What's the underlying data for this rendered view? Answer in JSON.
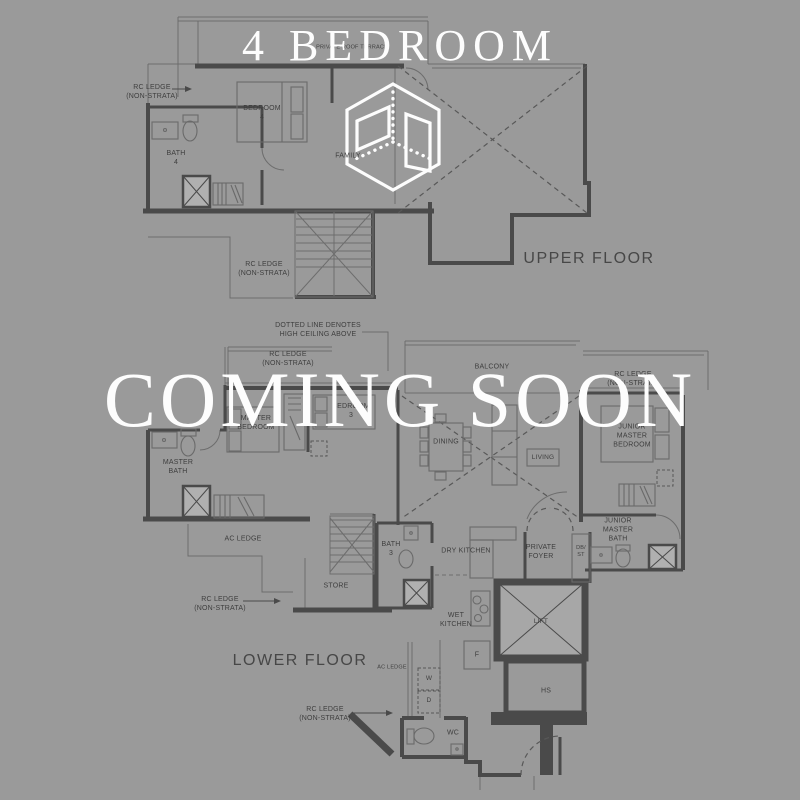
{
  "palette": {
    "background": "#9a9a9a",
    "wall": "#4a4a4a",
    "line": "#6d6d6d",
    "label": "#3e3e3e",
    "overlay": "#fdfdfd"
  },
  "overlay": {
    "title": "4 BEDROOM",
    "watermark": "COMING SOON",
    "logo_icon": "isometric-room-cube-logo"
  },
  "plan_labels": {
    "upper": {
      "floor_name": "UPPER FLOOR",
      "private_roof_terrace": "PRIVATE ROOF TERRACE",
      "rc_ledge_left": "RC LEDGE\n(NON-STRATA)",
      "bedroom_4": "BEDROOM\n4",
      "bath_4": "BATH\n4",
      "family": "FAMILY",
      "rc_ledge_mid": "RC LEDGE\n(NON-STRATA)"
    },
    "lower": {
      "floor_name": "LOWER FLOOR",
      "ceiling_note": "DOTTED LINE DENOTES\nHIGH CEILING ABOVE",
      "rc_ledge_top": "RC LEDGE\n(NON-STRATA)",
      "balcony": "BALCONY",
      "rc_ledge_right": "RC LEDGE\n(NON-STRATA)",
      "master_bedroom": "MASTER\nBEDROOM",
      "bedroom_3": "BEDROOM\n3",
      "dining": "DINING",
      "living": "LIVING",
      "junior_master_bedroom": "JUNIOR\nMASTER\nBEDROOM",
      "master_bath": "MASTER\nBATH",
      "ac_ledge": "AC LEDGE",
      "bath_3": "BATH\n3",
      "dry_kitchen": "DRY KITCHEN",
      "private_foyer": "PRIVATE\nFOYER",
      "db_st": "DB/\nST",
      "junior_master_bath": "JUNIOR\nMASTER\nBATH",
      "store": "STORE",
      "rc_ledge_left": "RC LEDGE\n(NON-STRATA)",
      "ac_ledge_small": "AC LEDGE",
      "wet_kitchen": "WET\nKITCHEN",
      "fridge": "F",
      "washer": "W",
      "dryer": "D",
      "lift": "LIFT",
      "household_shelter": "HS",
      "rc_ledge_bottom": "RC LEDGE\n(NON-STRATA)",
      "wc": "WC"
    }
  }
}
